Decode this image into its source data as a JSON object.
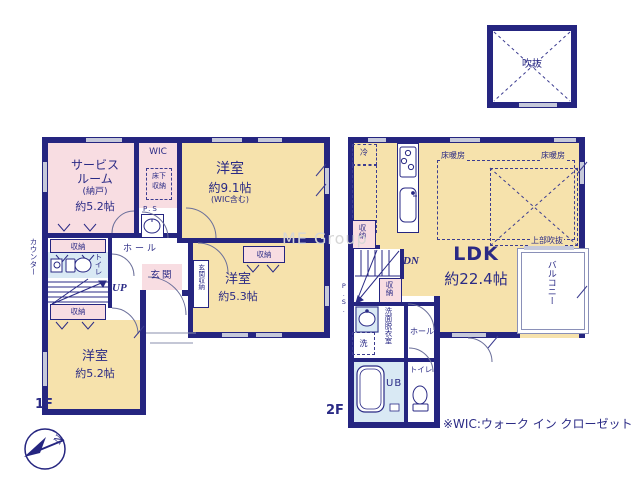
{
  "colors": {
    "wall": "#252580",
    "room_tan": "#f6e2ac",
    "room_pink": "#f8dde2",
    "room_blue": "#d9e9f4",
    "window_gray": "#c6c9da",
    "text_navy": "#2a2a85",
    "watermark_gray": "#d6d6d6"
  },
  "titles": {
    "floor1": "1F",
    "floor2": "2F",
    "wic_note": "※WIC:ウォーク イン クローゼット",
    "watermark": "ME Group",
    "compass": "N"
  },
  "void_box": {
    "label": "吹抜"
  },
  "f1": {
    "service": [
      "サービス",
      "ルーム",
      "(納戸)",
      "約5.2帖"
    ],
    "wic": "WIC",
    "underfloor": [
      "床下",
      "収納"
    ],
    "ps": "P.S",
    "counter": "カウンター",
    "closet1": "収納",
    "toilet": "トイレ",
    "up": "UP",
    "hall": "ホール",
    "entrance": "玄関",
    "entrance_storage": "玄関収納",
    "room91": {
      "name": "洋室",
      "size": "約9.1帖",
      "note": "(WIC含む)"
    },
    "closet3": "収納",
    "room53": {
      "name": "洋室",
      "size": "約5.3帖"
    },
    "closet2": "収納",
    "room52": {
      "name": "洋室",
      "size": "約5.2帖"
    }
  },
  "f2": {
    "fridge": "冷",
    "heat1": "床暖房",
    "heat2": "床暖房",
    "upper_void": "上部吹抜",
    "ldk": {
      "name": "LDK",
      "size": "約22.4帖"
    },
    "balcony": "バルコニー",
    "closet_top": "収納",
    "dn": "DN",
    "closet_mid": "収納",
    "ps": "P.S.",
    "wash": "洗",
    "washroom": "洗面脱衣室",
    "hall": "ホール",
    "ub": "UB",
    "toilet": "トイレ"
  }
}
